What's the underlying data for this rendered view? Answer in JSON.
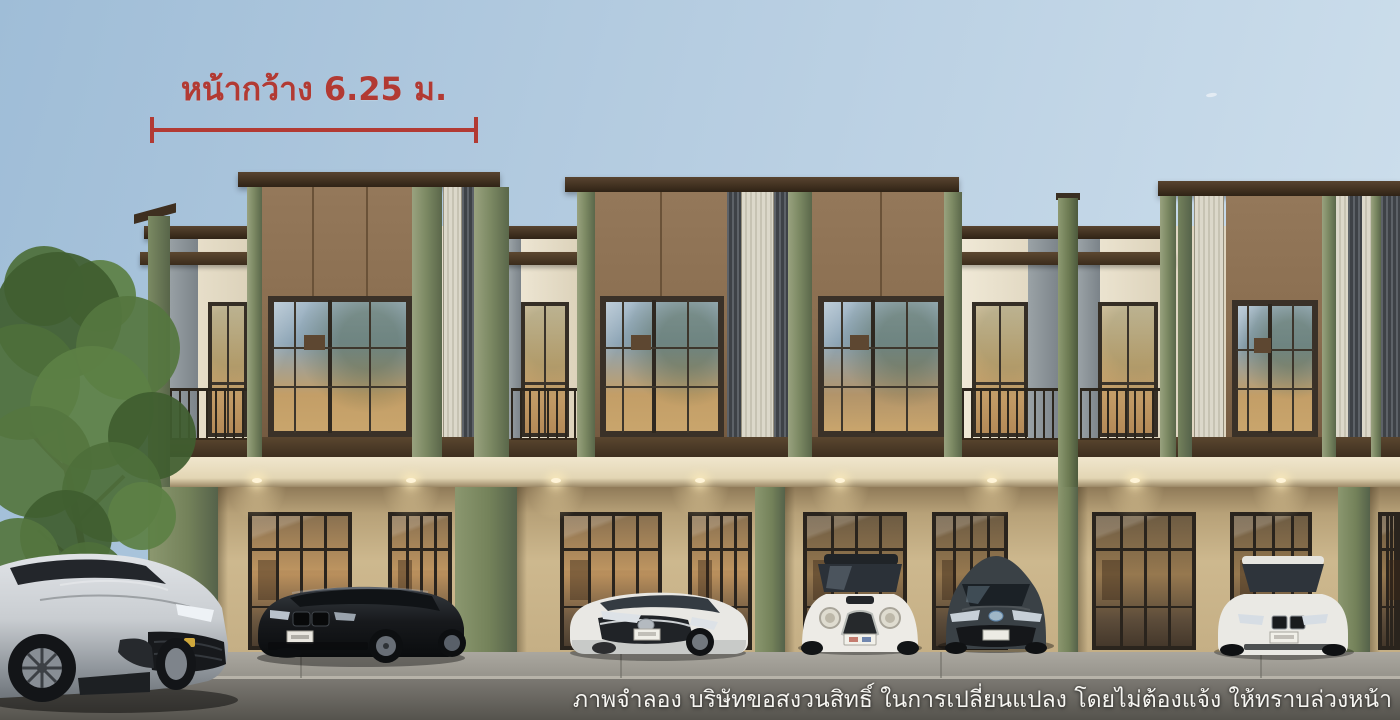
{
  "annotation": {
    "label": "หน้ากว้าง 6.25 ม.",
    "width_meters": "6.25"
  },
  "disclaimer": {
    "text": "ภาพจำลอง บริษัทขอสงวนสิทธิ์ ในการเปลี่ยนแปลง โดยไม่ต้องแจ้ง ให้ทราบล่วงหน้า"
  },
  "palette": {
    "annotation_red": "#b23a33",
    "sky_top": "#9fbdd7",
    "sky_bottom": "#cfe0ed",
    "facade_green": "#7d8a64",
    "facade_brown": "#8a6e50",
    "trim_dark_brown": "#44331f",
    "wall_cream": "#e9dfc8",
    "ground_wall_tan": "#cdb88e",
    "glass_warm": "#c09a62",
    "road_gray": "#6e6c66"
  },
  "scene": {
    "building": "two-storey-modern-townhome-row",
    "vehicles": [
      {
        "name": "silver-suv",
        "body": "#c9cdd1",
        "x": 0,
        "width": 235
      },
      {
        "name": "black-sedan",
        "body": "#17191c",
        "x": 256,
        "width": 210
      },
      {
        "name": "white-compact-sedan",
        "body": "#e9e8e4",
        "x": 568,
        "width": 180
      },
      {
        "name": "white-mini-hatch",
        "body": "#edebe6",
        "x": 798,
        "width": 124
      },
      {
        "name": "dark-crossover",
        "body": "#3a4146",
        "x": 942,
        "width": 110
      },
      {
        "name": "white-sedan",
        "body": "#eae9e4",
        "x": 1214,
        "width": 138
      }
    ]
  }
}
